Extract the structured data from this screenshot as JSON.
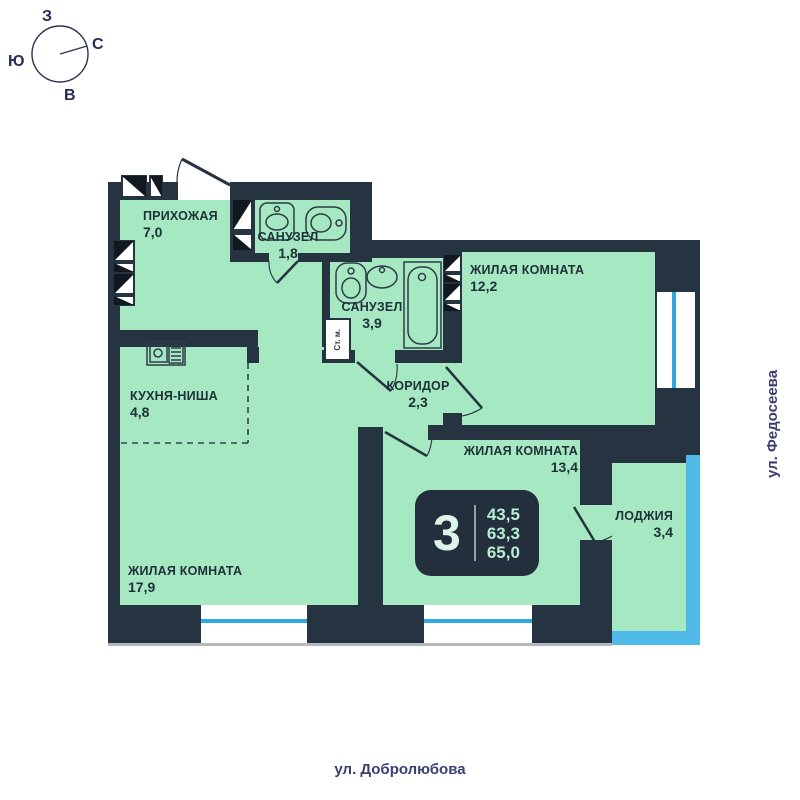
{
  "compass": {
    "west": "З",
    "north": "С",
    "south": "Ю",
    "east": "В"
  },
  "rooms": [
    {
      "name": "ПРИХОЖАЯ",
      "area": "7,0"
    },
    {
      "name": "САНУЗЕЛ",
      "area": "1,8"
    },
    {
      "name": "САНУЗЕЛ",
      "area": "3,9"
    },
    {
      "name": "ЖИЛАЯ КОМНАТА",
      "area": "12,2"
    },
    {
      "name": "КУХНЯ-НИША",
      "area": "4,8"
    },
    {
      "name": "КОРИДОР",
      "area": "2,3"
    },
    {
      "name": "ЖИЛАЯ КОМНАТА",
      "area": "13,4"
    },
    {
      "name": "ЖИЛАЯ КОМНАТА",
      "area": "17,9"
    },
    {
      "name": "ЛОДЖИЯ",
      "area": "3,4"
    }
  ],
  "badge": {
    "rooms_count": "3",
    "areas": [
      "43,5",
      "63,3",
      "65,0"
    ]
  },
  "fixtures": {
    "washing_machine_label": "Ст. м."
  },
  "streets": {
    "right": "ул. Федосеева",
    "bottom": "ул. Добролюбова"
  },
  "colors": {
    "wall": "#263340",
    "room_fill": "#a6e8c1",
    "glazing": "#4fb9e8",
    "window_line": "#2da9e0",
    "badge_bg": "#232f3c",
    "badge_text": "#b9eed2",
    "street_text": "#3a3e71",
    "facade_line": "#b2b8be"
  }
}
